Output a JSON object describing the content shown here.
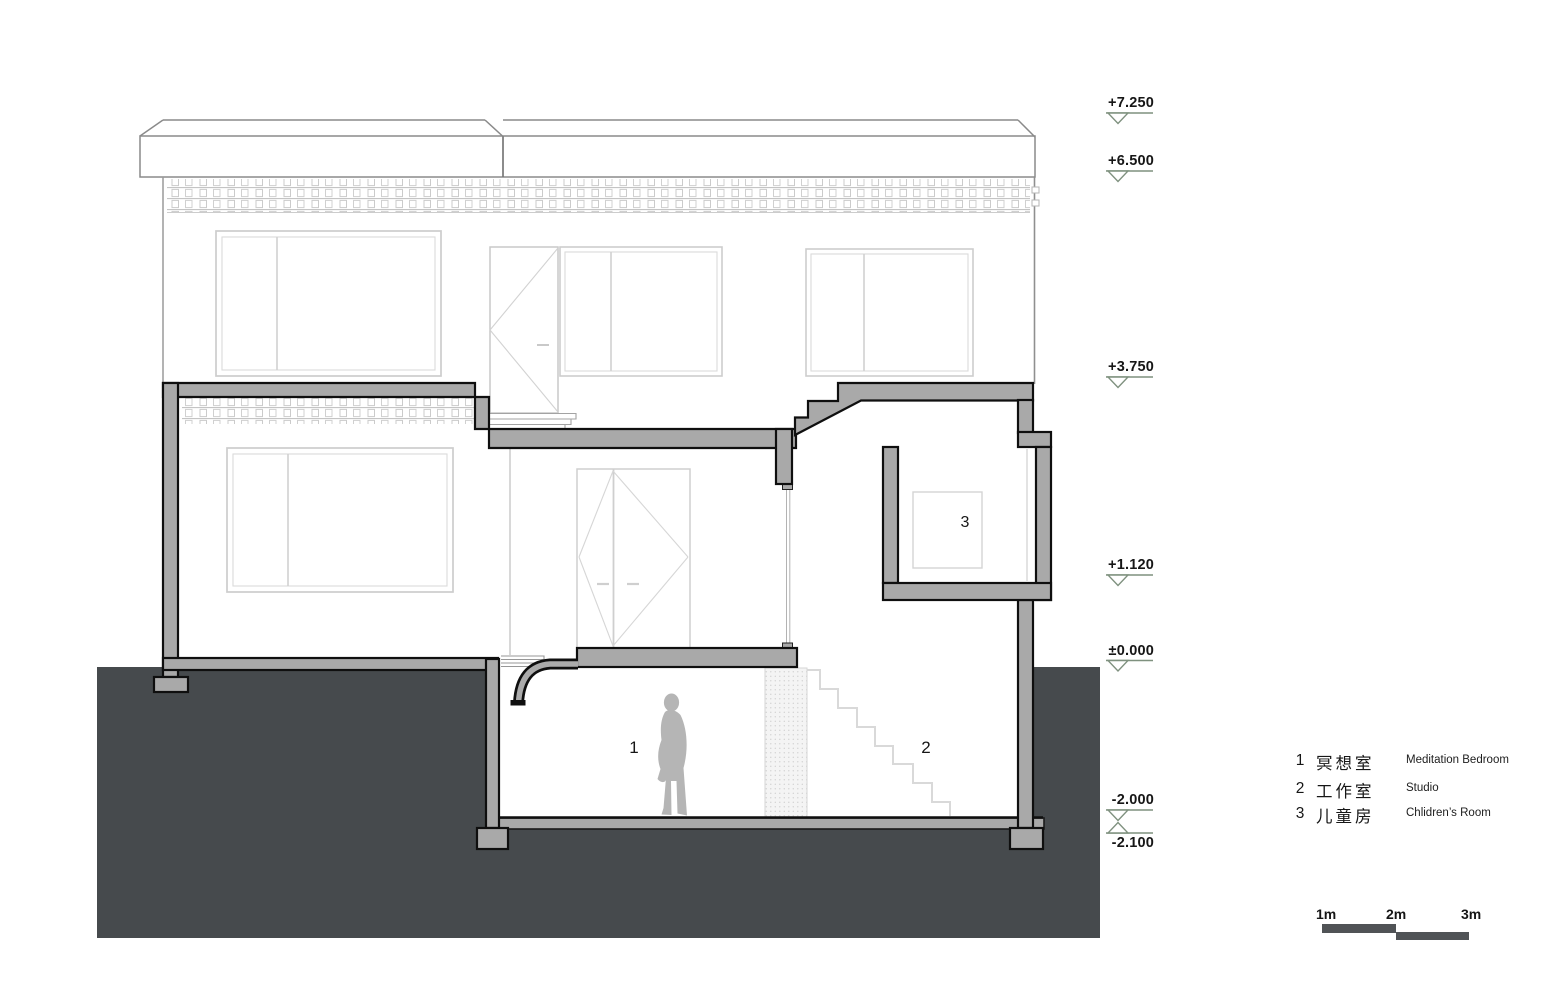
{
  "markers": [
    {
      "value": "+7.250"
    },
    {
      "value": "+6.500"
    },
    {
      "value": "+3.750"
    },
    {
      "value": "+1.120"
    },
    {
      "value": "±0.000"
    },
    {
      "value": "-2.000"
    },
    {
      "value": "-2.100"
    }
  ],
  "rooms": [
    {
      "number": "1",
      "label_cn": "冥想室",
      "label_en": "Meditation Bedroom"
    },
    {
      "number": "2",
      "label_cn": "工作室",
      "label_en": "Studio"
    },
    {
      "number": "3",
      "label_cn": "儿童房",
      "label_en": "Chlidren’s Room"
    }
  ],
  "scalebar": {
    "labels": [
      "1m",
      "2m",
      "3m"
    ]
  },
  "colors": {
    "ground": "#464a4d",
    "cut_wall": "#a9a9a9",
    "outline": "#111111",
    "marker_green": "#7f917f",
    "light_lines": "#cdcdcd",
    "scale_bar": "#505356"
  }
}
